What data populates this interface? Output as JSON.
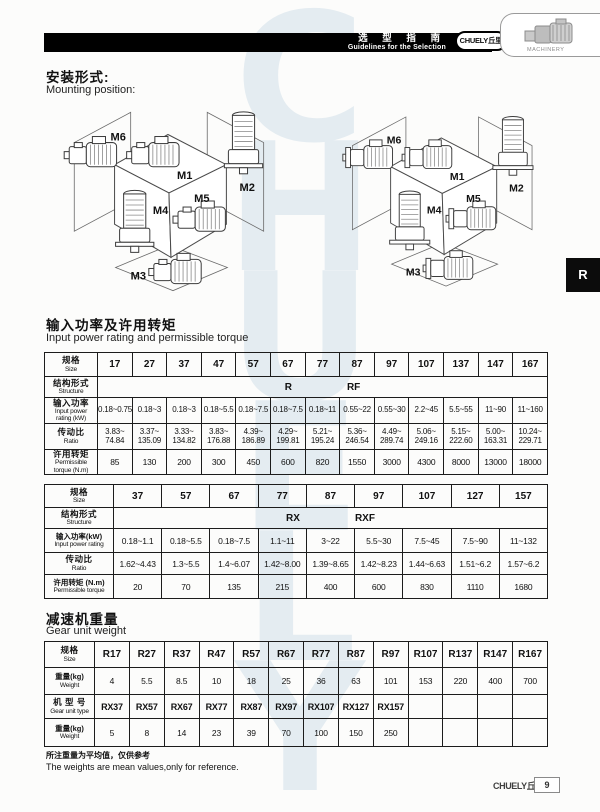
{
  "header": {
    "bar_cn": "选 型 指 南",
    "bar_en": "Guidelines for the Selection",
    "brand": "CHUELY丘里",
    "machinery": "MACHINERY"
  },
  "side_tab": {
    "label": "R"
  },
  "watermark": {
    "text": "C\nH\nU\nE\nL\nY"
  },
  "mounting": {
    "heading_cn": "安装形式:",
    "heading_en": "Mounting position:",
    "labels": [
      "M1",
      "M2",
      "M3",
      "M4",
      "M5",
      "M6"
    ]
  },
  "power_section": {
    "heading_cn": "输入功率及许用转矩",
    "heading_en": "Input power rating and permissible torque"
  },
  "table1": {
    "rows": {
      "size_cn": "规格",
      "size_en": "Size",
      "struct_cn": "结构形式",
      "struct_en": "Structure",
      "power_cn": "输入功率",
      "power_en": "Input power",
      "power_unit": "rating  (kW)",
      "ratio_cn": "传动比",
      "ratio_en": "Ratio",
      "torque_cn": "许用转矩",
      "torque_en": "Permissible",
      "torque_unit": "torque (N.m)"
    },
    "sizes": [
      "17",
      "27",
      "37",
      "47",
      "57",
      "67",
      "77",
      "87",
      "97",
      "107",
      "137",
      "147",
      "167"
    ],
    "structure": [
      "R",
      "RF"
    ],
    "power": [
      "0.18~0.75",
      "0.18~3",
      "0.18~3",
      "0.18~5.5",
      "0.18~7.5",
      "0.18~7.5",
      "0.18~11",
      "0.55~22",
      "0.55~30",
      "2.2~45",
      "5.5~55",
      "11~90",
      "11~160"
    ],
    "ratio": [
      "3.83~\n74.84",
      "3.37~\n135.09",
      "3.33~\n134.82",
      "3.83~\n176.88",
      "4.39~\n186.89",
      "4.29~\n199.81",
      "5.21~\n195.24",
      "5.36~\n246.54",
      "4.49~\n289.74",
      "5.06~\n249.16",
      "5.15~\n222.60",
      "5.00~\n163.31",
      "10.24~\n229.71"
    ],
    "torque": [
      "85",
      "130",
      "200",
      "300",
      "450",
      "600",
      "820",
      "1550",
      "3000",
      "4300",
      "8000",
      "13000",
      "18000"
    ]
  },
  "table2": {
    "rows": {
      "size_cn": "规格",
      "size_en": "Size",
      "struct_cn": "结构形式",
      "struct_en": "Structure",
      "power_cn": "输入功率(kW)",
      "power_en": "Input power rating",
      "ratio_cn": "传动比",
      "ratio_en": "Ratio",
      "torque_cn": "许用转矩 (N.m)",
      "torque_en": "Permissible torque"
    },
    "sizes": [
      "37",
      "57",
      "67",
      "77",
      "87",
      "97",
      "107",
      "127",
      "157"
    ],
    "structure": [
      "RX",
      "RXF"
    ],
    "power": [
      "0.18~1.1",
      "0.18~5.5",
      "0.18~7.5",
      "1.1~11",
      "3~22",
      "5.5~30",
      "7.5~45",
      "7.5~90",
      "11~132"
    ],
    "ratio": [
      "1.62~4.43",
      "1.3~5.5",
      "1.4~6.07",
      "1.42~8.00",
      "1.39~8.65",
      "1.42~8.23",
      "1.44~6.63",
      "1.51~6.2",
      "1.57~6.2"
    ],
    "torque": [
      "20",
      "70",
      "135",
      "215",
      "400",
      "600",
      "830",
      "1110",
      "1680"
    ]
  },
  "weight_section": {
    "heading_cn": "减速机重量",
    "heading_en": "Gear unit weight"
  },
  "table3": {
    "rows": {
      "size_cn": "规格",
      "size_en": "Size",
      "weight_cn": "重量(kg)",
      "weight_en": "Weight",
      "type_cn": "机 型 号",
      "type_en": "Gear unit type"
    },
    "sizes": [
      "R17",
      "R27",
      "R37",
      "R47",
      "R57",
      "R67",
      "R77",
      "R87",
      "R97",
      "R107",
      "R137",
      "R147",
      "R167"
    ],
    "weights": [
      "4",
      "5.5",
      "8.5",
      "10",
      "18",
      "25",
      "36",
      "63",
      "101",
      "153",
      "220",
      "400",
      "700"
    ],
    "types": [
      "RX37",
      "RX57",
      "RX67",
      "RX77",
      "RX87",
      "RX97",
      "RX107",
      "RX127",
      "RX157",
      "",
      "",
      "",
      ""
    ],
    "type_weights": [
      "5",
      "8",
      "14",
      "23",
      "39",
      "70",
      "100",
      "150",
      "250",
      "",
      "",
      "",
      ""
    ]
  },
  "notes": {
    "cn": "所注重量为平均值，仅供参考",
    "en": "The weights are mean values,only for reference."
  },
  "footer": {
    "brand": "CHUELY丘里",
    "page": "9"
  }
}
